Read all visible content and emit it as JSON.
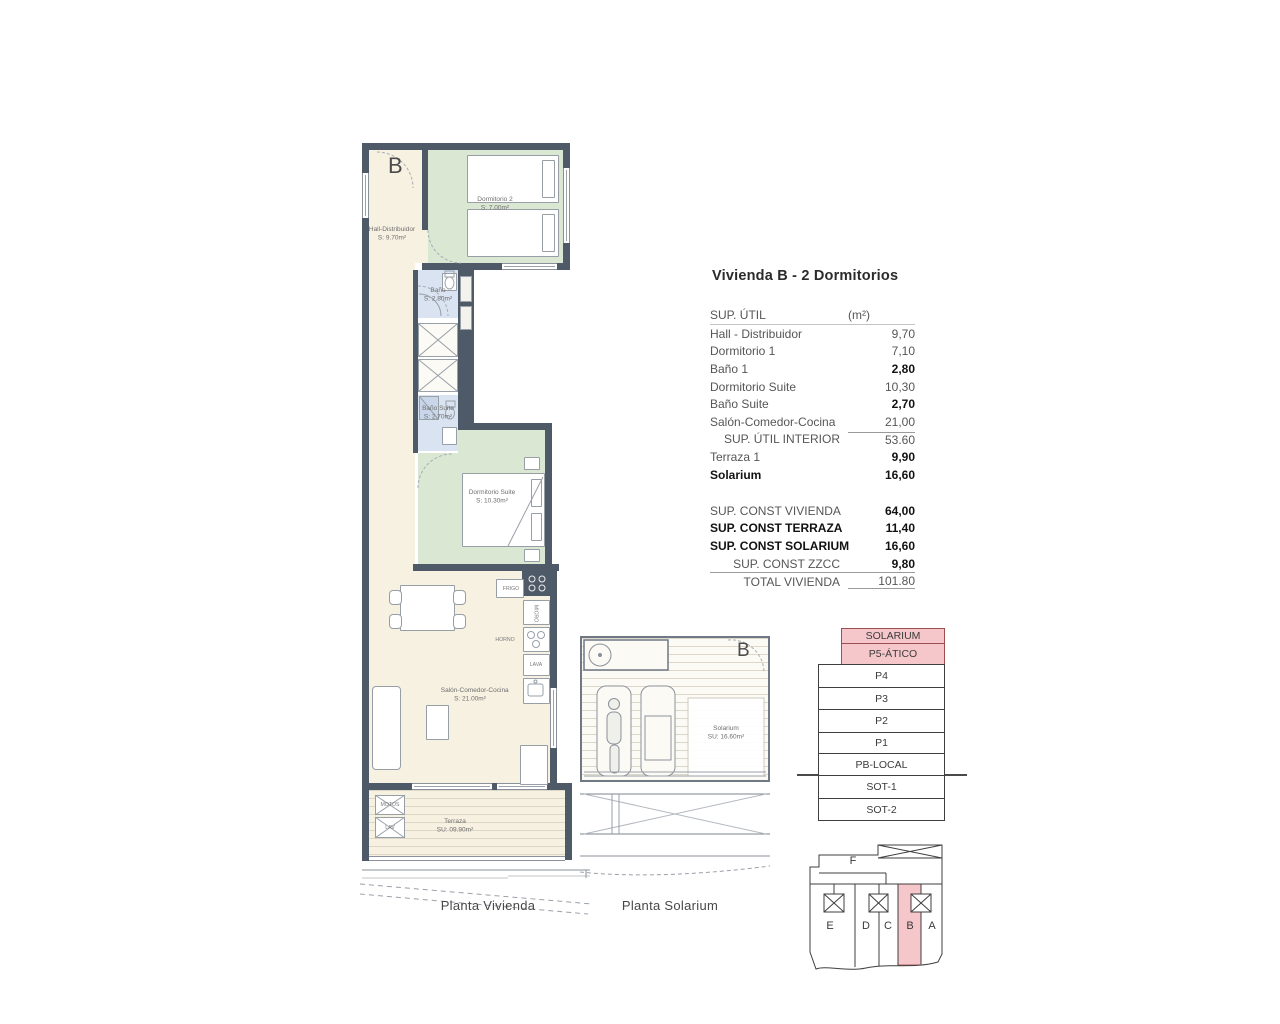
{
  "title": "Vivienda B - 2 Dormitorios",
  "area_table": {
    "header": {
      "label": "SUP. ÚTIL",
      "unit": "(m²)"
    },
    "rows": [
      {
        "label": "Hall - Distribuidor",
        "value": "9,70"
      },
      {
        "label": "Dormitorio 1",
        "value": "7,10"
      },
      {
        "label": "Baño 1",
        "value": "2,80"
      },
      {
        "label": "Dormitorio Suite",
        "value": "10,30"
      },
      {
        "label": "Baño Suite",
        "value": "2,70"
      },
      {
        "label": "Salón-Comedor-Cocina",
        "value": "21,00"
      },
      {
        "label": "SUP. ÚTIL INTERIOR",
        "value": "53.60"
      },
      {
        "label": "Terraza 1",
        "value": "9,90"
      },
      {
        "label": "Solarium",
        "value": "16,60"
      }
    ]
  },
  "const_table": {
    "rows": [
      {
        "label": "SUP. CONST VIVIENDA",
        "value": "64,00"
      },
      {
        "label": "SUP. CONST TERRAZA",
        "value": "11,40"
      },
      {
        "label": "SUP. CONST SOLARIUM",
        "value": "16,60"
      },
      {
        "label": "SUP. CONST ZZCC",
        "value": "9,80"
      },
      {
        "label": "TOTAL VIVIENDA",
        "value": "101.80"
      }
    ]
  },
  "vivienda_plan": {
    "unit_letter": "B",
    "caption": "Planta Vivienda",
    "rooms": {
      "hall": {
        "name": "Hall-Distribuidor",
        "area": "S: 9.70m²"
      },
      "dormitorio2": {
        "name": "Dormitorio 2",
        "area": "S: 7.00m²"
      },
      "bano": {
        "name": "Baño",
        "area": "S: 2.80m²"
      },
      "bano_suite": {
        "name": "Baño Suite",
        "area": "S: 2.70m²"
      },
      "dormitorio_suite": {
        "name": "Dormitorio Suite",
        "area": "S: 10.30m²"
      },
      "salon": {
        "name": "Salón-Comedor-Cocina",
        "area": "S: 21.00m²"
      },
      "terraza": {
        "name": "Terraza",
        "area": "SU: 09.90m²"
      }
    },
    "labels": {
      "frigo": "FRIGO",
      "micro": "MICRO",
      "horno": "HORNO",
      "lava": "LAVA",
      "motos": "MOTOS",
      "lav": "LAV"
    }
  },
  "solarium_plan": {
    "unit_letter": "B",
    "caption": "Planta Solarium",
    "room": {
      "name": "Solarium",
      "area": "SU: 16.60m²"
    }
  },
  "level_stack": {
    "levels": [
      {
        "label": "SOLARIUM",
        "highlight": true
      },
      {
        "label": "P5-ÁTICO",
        "highlight": true
      },
      {
        "label": "P4"
      },
      {
        "label": "P3"
      },
      {
        "label": "P2"
      },
      {
        "label": "P1"
      },
      {
        "label": "PB-LOCAL"
      },
      {
        "label": "SOT-1"
      },
      {
        "label": "SOT-2"
      }
    ]
  },
  "site_plan": {
    "top_unit": "F",
    "units": [
      "E",
      "D",
      "C",
      "B",
      "A"
    ],
    "highlighted_unit": "B"
  },
  "colors": {
    "wall": "#4f5a68",
    "bedroom_green": "#d9e7d3",
    "bath_blue": "#d9e3f1",
    "floor_cream": "#f7f1e2",
    "highlight_pink": "#f5c6ca",
    "highlight_border": "#9c4f4f"
  }
}
